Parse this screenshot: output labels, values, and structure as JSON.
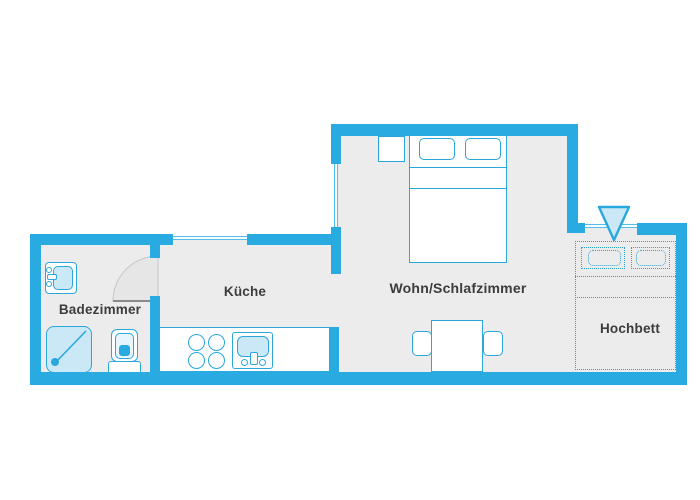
{
  "floor_plan": {
    "rooms": [
      {
        "name": "badezimmer",
        "label": "Badezimmer"
      },
      {
        "name": "kueche",
        "label": "Küche"
      },
      {
        "name": "wohn-schlafzimmer",
        "label": "Wohn/Schlafzimmer"
      },
      {
        "name": "hochbett",
        "label": "Hochbett"
      }
    ],
    "icons": [
      "double-bed-icon",
      "pillow-icon",
      "nightstand-icon",
      "dining-table-icon",
      "chair-icon",
      "stove-burner-icon",
      "kitchen-sink-icon",
      "bathroom-sink-icon",
      "shower-icon",
      "toilet-icon",
      "door-swing-icon",
      "loft-bed-icon",
      "down-arrow-icon",
      "window-icon"
    ],
    "colors": {
      "wall": "#29abe2",
      "room_fill": "#ececec",
      "fixture_light_blue": "#cbe8f7",
      "dotted_outline": "#2aa0d6",
      "label_text": "#3c3c3c",
      "background": "#ffffff"
    }
  }
}
